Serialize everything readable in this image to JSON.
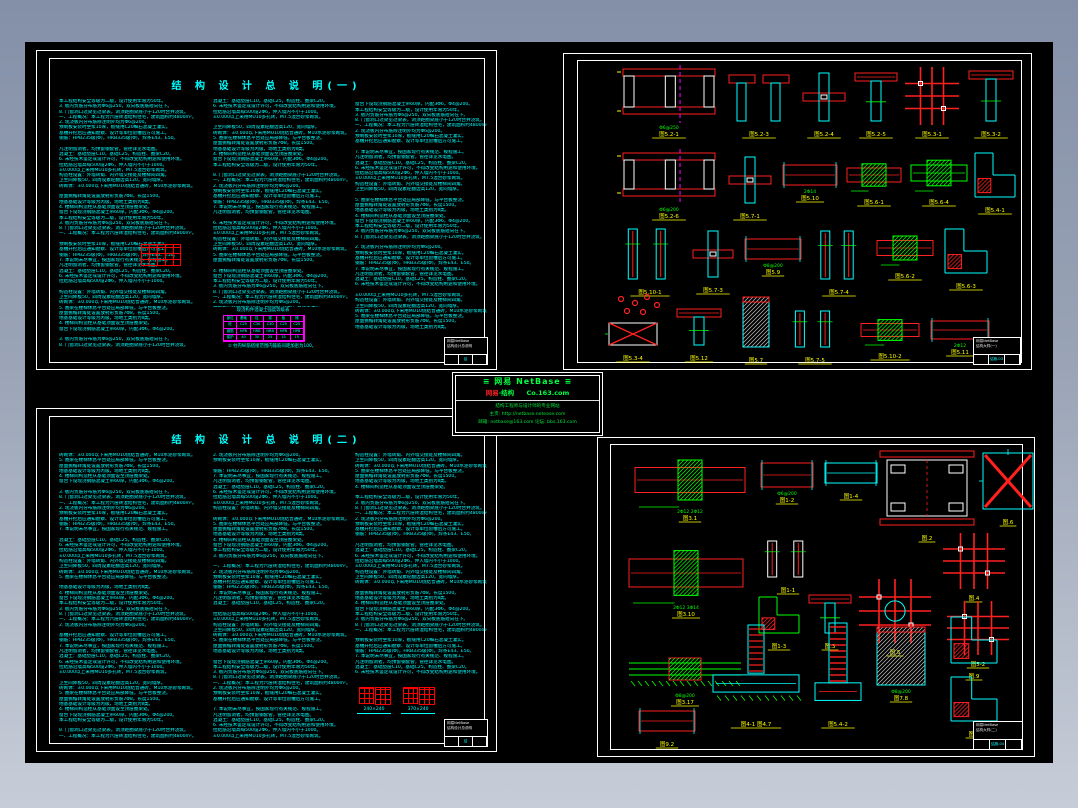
{
  "app": {
    "type": "cad-drawing-viewer"
  },
  "colors": {
    "cyan": "#00ffff",
    "red": "#ff2020",
    "green": "#00ff00",
    "yellow": "#ffff00",
    "magenta": "#ff00ff",
    "border_top": "#8490a8",
    "border_bottom": "#c7cdd8"
  },
  "watermark": {
    "t1": "≡  网易 NetBase  ≡",
    "brand_red": "网易",
    "brand_green": "·结构",
    "site": "Co.163.com",
    "s1": "结构工程师与设计师的专业网站",
    "s2": "主页: http://netbase.netease.com",
    "s3": "邮箱: netbase@163.com  论坛: bbs.163.com"
  },
  "filler_lines": [
    "一、工程概况：本工程为六层砖混结构住宅，建筑面积约4800m²。",
    "本工程结构安全等级为二级，设计使用年限为50年。",
    "地基基础设计等级为丙级，场地土类别为Ⅱ类。",
    "砖砌体：±0.000以下采用MU10烧结普通砖，M10水泥砂浆砌筑。",
    "±0.000以上采用MU10多孔砖，M7.5混合砂浆砌筑。",
    "混凝土：基础垫层C10，基础C25，构造柱、圈梁C20。",
    "钢筋：HPB235级(Φ)，HRB335级(Φ)，焊条E43、E50。",
    "2. 现浇板内分布筋除注明外均为Φ6@200。",
    "3. 板内负筋分布筋为Φ6@250，双向板底筋短向在下。",
    "4. 楼梯间构造柱从基础顶面设至顶层圈梁处。",
    "5. 圈梁在楼梯休息平台处应局部降低，与平台板整浇。",
    "构造柱设置：外墙转角、内外墙交接处及楼梯间四角。",
    "6. 未经技术鉴定或设计许可，不得改变结构用途和使用环境。",
    "7. 本说明未尽事宜，按国家现行有关规范、规程施工。",
    "预制板安装时坐浆10厚，板缝用C20细石混凝土灌实。",
    "8. 门窗洞口过梁见过梁表，洞顶距圈梁底小于120时合并浇筑。",
    "窗台下设现浇钢筋混凝土带60厚，内配3Φ6，Φ4@200。",
    "屋面挑檐转角处设置放射形负筋7Φ8，长度1500。",
    "卫生间降板50，四周设素砼翻边高120，宽同墙厚。",
    "拉结筋沿墙高每500设2Φ6，伸入墙内不小于1000。",
    "凡注明留洞者，均预留钢套管，管径详见水电图。",
    "基槽开挖后应通知勘察、设计等单位验槽后方可施工。"
  ],
  "sheets": {
    "top_left": {
      "title": "结 构 设 计 总 说 明(一)",
      "columns": [
        {
          "lines": 47
        },
        {
          "lines": 40
        },
        {
          "lines": 44
        }
      ],
      "table": {
        "caption": "现浇构件混凝土强度等级表",
        "note": "② 柱内纵筋搭接范围内箍筋间距加密为100。",
        "cells": [
          [
            "部位",
            "基础",
            "柱",
            "梁",
            "板",
            "梯"
          ],
          [
            "砼",
            "C25",
            "C30",
            "C30",
            "C25",
            "C25"
          ],
          [
            "钢筋",
            "HPB",
            "HRB",
            "HRB",
            "HPB",
            "HPB"
          ],
          [
            "保护",
            "40",
            "30",
            "25",
            "15",
            "15"
          ]
        ]
      },
      "title_block": {
        "l1": "网易NetBase",
        "l2": "结构设计总说明",
        "no": "结施-01"
      }
    },
    "bottom_left": {
      "title": "结 构 设 计 总 说 明(二)",
      "columns": [
        {
          "lines": 54
        },
        {
          "lines": 54
        },
        {
          "lines": 42
        }
      ],
      "sections": {
        "labels": [
          "240×240",
          "370×240"
        ]
      },
      "title_block": {
        "l1": "网易NetBase",
        "l2": "结构设计总说明",
        "no": "结施-02"
      }
    },
    "top_right": {
      "title_block": {
        "l1": "网易NetBase",
        "l2": "结构大样(一)",
        "no": "结施-03"
      },
      "details": [
        {
          "t": "plan",
          "x": 44,
          "y": 8,
          "w": 92,
          "h": 52,
          "label": "图5.2-1",
          "dims": "Φ6@250"
        },
        {
          "t": "tee2",
          "x": 150,
          "y": 14,
          "w": 60,
          "h": 46,
          "label": "图5.2-3"
        },
        {
          "t": "cross",
          "x": 224,
          "y": 12,
          "w": 42,
          "h": 48,
          "label": "图5.2-4"
        },
        {
          "t": "tee",
          "x": 276,
          "y": 12,
          "w": 42,
          "h": 48,
          "label": "图5.2-5"
        },
        {
          "t": "grid",
          "x": 330,
          "y": 10,
          "w": 46,
          "h": 50,
          "label": "图5.3-1"
        },
        {
          "t": "tee",
          "x": 390,
          "y": 10,
          "w": 44,
          "h": 50,
          "label": "图5.3-2"
        },
        {
          "t": "plan",
          "x": 44,
          "y": 92,
          "w": 92,
          "h": 50,
          "label": "图5.2-6",
          "dims": "Φ6@200"
        },
        {
          "t": "cross",
          "x": 150,
          "y": 96,
          "w": 42,
          "h": 46,
          "label": "图5.7-1"
        },
        {
          "t": "beam",
          "x": 204,
          "y": 104,
          "w": 54,
          "h": 20,
          "label": "图5.10",
          "dims": "2Φ14"
        },
        {
          "t": "beamg",
          "x": 268,
          "y": 100,
          "w": 54,
          "h": 28,
          "label": "图5.6-1"
        },
        {
          "t": "beamg",
          "x": 332,
          "y": 96,
          "w": 56,
          "h": 32,
          "label": "图5.6-4",
          "c1": "#00ff00"
        },
        {
          "t": "lsec",
          "x": 396,
          "y": 92,
          "w": 40,
          "h": 44,
          "label": "图5.4-1"
        },
        {
          "t": "colpair",
          "x": 40,
          "y": 168,
          "w": 62,
          "h": 50,
          "label": "图5.10-1"
        },
        {
          "t": "cross",
          "x": 114,
          "y": 170,
          "w": 40,
          "h": 46,
          "label": "图5.7-3"
        },
        {
          "t": "beam",
          "x": 166,
          "y": 178,
          "w": 56,
          "h": 20,
          "label": "图5.9",
          "dims": "Φ8@200"
        },
        {
          "t": "colpair",
          "x": 234,
          "y": 170,
          "w": 52,
          "h": 48,
          "label": "图5.7-4"
        },
        {
          "t": "beamg",
          "x": 298,
          "y": 172,
          "w": 56,
          "h": 30,
          "label": "图5.6-2"
        },
        {
          "t": "lsec",
          "x": 366,
          "y": 168,
          "w": 42,
          "h": 44,
          "label": "图5.6-3"
        },
        {
          "t": "scatter",
          "x": 34,
          "y": 232,
          "w": 52,
          "h": 24
        },
        {
          "t": "xbox",
          "x": 30,
          "y": 262,
          "w": 48,
          "h": 22,
          "label": "图5.3-4"
        },
        {
          "t": "tee",
          "x": 98,
          "y": 248,
          "w": 44,
          "h": 36,
          "label": "图5.12"
        },
        {
          "t": "hatch",
          "x": 164,
          "y": 236,
          "w": 26,
          "h": 50,
          "label": "图5.7"
        },
        {
          "t": "colpair",
          "x": 208,
          "y": 250,
          "w": 56,
          "h": 36,
          "label": "图5.7-5"
        },
        {
          "t": "beamg",
          "x": 282,
          "y": 256,
          "w": 58,
          "h": 26,
          "label": "图5.10-2"
        },
        {
          "t": "beam",
          "x": 352,
          "y": 260,
          "w": 58,
          "h": 18,
          "label": "图5.11",
          "dims": "2Φ12"
        }
      ]
    },
    "bottom_right": {
      "title_block": {
        "l1": "网易NetBase",
        "l2": "结构大样(二)",
        "no": "结施-04"
      },
      "details": [
        {
          "t": "beamg",
          "x": 24,
          "y": 10,
          "w": 110,
          "h": 50,
          "label": "图3.1",
          "dims": "2Φ12  2Φ12"
        },
        {
          "t": "beam",
          "x": 150,
          "y": 18,
          "w": 52,
          "h": 24,
          "label": "图1-2",
          "dims": "Φ6@200"
        },
        {
          "t": "beam",
          "x": 214,
          "y": 18,
          "w": 52,
          "h": 20,
          "label": "图1-4",
          "c1": "#00ffff"
        },
        {
          "t": "frame",
          "x": 272,
          "y": 6,
          "w": 88,
          "h": 74,
          "label": "图.2"
        },
        {
          "t": "xbig",
          "x": 372,
          "y": 8,
          "w": 50,
          "h": 56,
          "label": "图.6"
        },
        {
          "t": "beamg",
          "x": 18,
          "y": 100,
          "w": 114,
          "h": 56,
          "label": "图3.10",
          "dims": "2Φ12 3Φ14"
        },
        {
          "t": "colpair",
          "x": 148,
          "y": 96,
          "w": 58,
          "h": 36,
          "label": "图1-1",
          "c2": "#ffffff"
        },
        {
          "t": "lsec",
          "x": 148,
          "y": 152,
          "w": 40,
          "h": 36,
          "label": "图1-3",
          "c2": "#00ff00"
        },
        {
          "t": "tee",
          "x": 198,
          "y": 150,
          "w": 42,
          "h": 38,
          "label": "图.3"
        },
        {
          "t": "grid",
          "x": 252,
          "y": 138,
          "w": 64,
          "h": 56,
          "label": "图.5",
          "circ": true
        },
        {
          "t": "grid",
          "x": 336,
          "y": 92,
          "w": 54,
          "h": 48,
          "label": "图.4"
        },
        {
          "t": "grid",
          "x": 340,
          "y": 160,
          "w": 54,
          "h": 46,
          "label": "图5-2"
        },
        {
          "t": "wide",
          "x": 18,
          "y": 212,
          "w": 112,
          "h": 32,
          "label": "图3.17",
          "dims": "Φ8@200"
        },
        {
          "t": "beam",
          "x": 28,
          "y": 266,
          "w": 56,
          "h": 20,
          "label": "图9.2"
        },
        {
          "t": "found",
          "x": 102,
          "y": 180,
          "w": 86,
          "h": 86,
          "label": "图4-1 图4.7"
        },
        {
          "t": "step",
          "x": 204,
          "y": 178,
          "w": 46,
          "h": 88,
          "label": "图5.4-2"
        },
        {
          "t": "hatch",
          "x": 266,
          "y": 182,
          "w": 48,
          "h": 58,
          "label": "图7.8",
          "dims": "Φ8@200"
        },
        {
          "t": "lsec",
          "x": 340,
          "y": 172,
          "w": 46,
          "h": 46,
          "label": "图.9"
        },
        {
          "t": "lsec",
          "x": 340,
          "y": 232,
          "w": 46,
          "h": 44,
          "label": "图.7"
        }
      ]
    }
  }
}
